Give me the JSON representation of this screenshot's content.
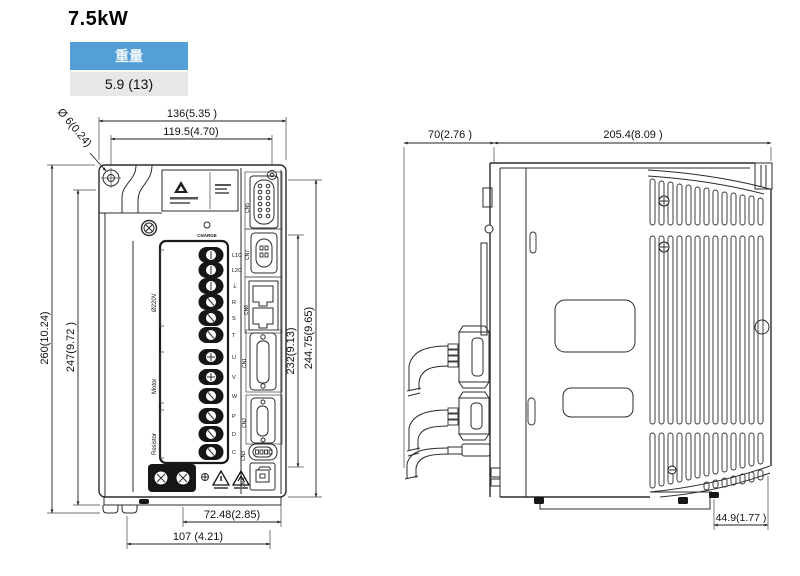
{
  "title": "7.5kW",
  "weight_table": {
    "header": "重量",
    "value": "5.9 (13)"
  },
  "colors": {
    "table_header_bg": "#549fd7",
    "table_row_bg": "#e6e7e9"
  },
  "front_view": {
    "dims": {
      "width_outer": "136(5.35 )",
      "width_holes": "119.5(4.70)",
      "hole_diameter": "Ø 6(0.24)",
      "height_outer": "260(10.24)",
      "height_inner": "247(9.72 )",
      "height_terminal": "232(9.13)",
      "height_body": "244.75(9.65)",
      "bottom_inner": "72.48(2.85)",
      "bottom_outer": "107 (4.21)"
    },
    "labels": {
      "charge": "CHARGE",
      "power": "Ø220V",
      "motor": "Motor",
      "resistor": "Resistor"
    },
    "connectors": {
      "cn5": "CN5",
      "cn7": "CN7",
      "cn6": "CN6",
      "cn1": "CN1",
      "cn2": "CN2",
      "cn3": "CN3",
      "cn4": "CN4"
    },
    "terminals": [
      "L1C",
      "L2C",
      "⏚",
      "R",
      "S",
      "T",
      "U",
      "V",
      "W",
      "P",
      "D",
      "C"
    ]
  },
  "side_view": {
    "dims": {
      "front_depth": "70(2.76 )",
      "body_depth": "205.4(8.09 )",
      "bottom_notch": "44.9(1.77 )"
    }
  }
}
